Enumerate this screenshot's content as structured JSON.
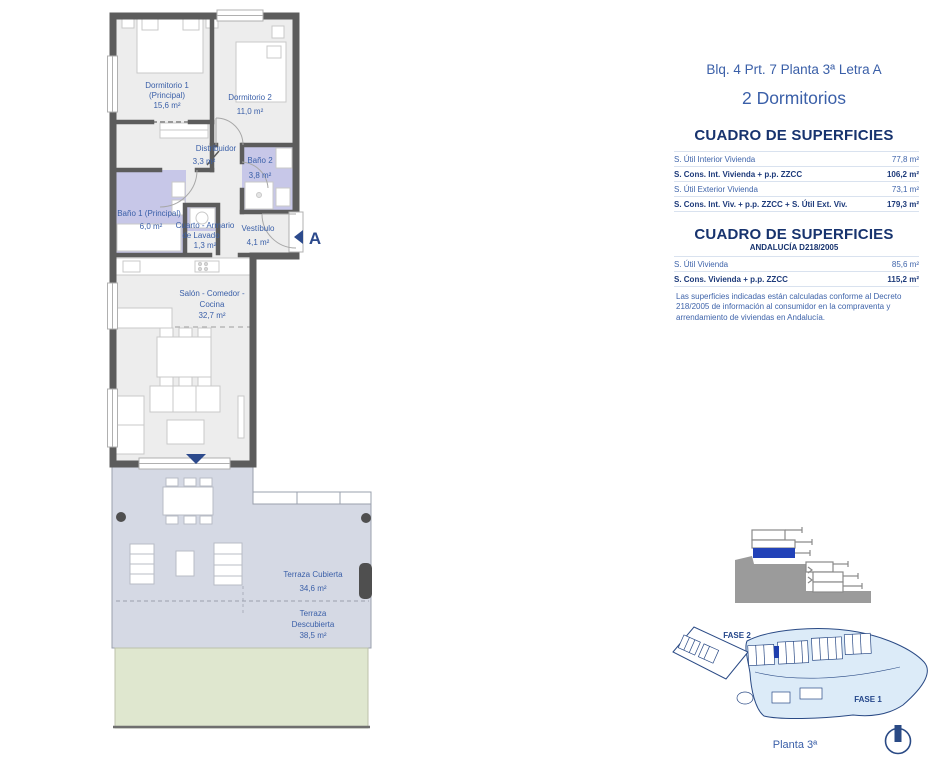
{
  "header": {
    "title": "Blq. 4 Prt. 7 Planta 3ª Letra A",
    "subtitle": "2 Dormitorios"
  },
  "surfaces": {
    "heading": "CUADRO DE SUPERFICIES",
    "rows": [
      {
        "label": "S. Útil Interior Vivienda",
        "value": "77,8 m²"
      },
      {
        "label": "S. Cons. Int. Vivienda + p.p. ZZCC",
        "value": "106,2 m²"
      },
      {
        "label": "S. Útil Exterior Vivienda",
        "value": "73,1 m²"
      },
      {
        "label": "S. Cons. Int. Viv. + p.p. ZZCC + S. Útil Ext. Viv.",
        "value": "179,3 m²"
      }
    ]
  },
  "surfaces_andalucia": {
    "heading": "CUADRO DE SUPERFICIES",
    "subheading": "ANDALUCÍA D218/2005",
    "rows": [
      {
        "label": "S. Útil Vivienda",
        "value": "85,6 m²"
      },
      {
        "label": "S. Cons. Vivienda + p.p. ZZCC",
        "value": "115,2 m²"
      }
    ],
    "note": "Las superficies indicadas están calculadas conforme al Decreto 218/2005 de información al consumidor en la compraventa y arrendamiento de viviendas en Andalucía."
  },
  "floorplan": {
    "rooms": {
      "dormitorio1": {
        "name": "Dormitorio 1",
        "sub": "(Principal)",
        "area": "15,6 m²"
      },
      "dormitorio2": {
        "name": "Dormitorio 2",
        "area": "11,0 m²"
      },
      "distribuidor": {
        "name": "Distribuidor",
        "area": "3,3 m²"
      },
      "bano2": {
        "name": "Baño 2",
        "area": "3,8 m²"
      },
      "bano1": {
        "name": "Baño 1 (Principal)",
        "area": "6,0 m²"
      },
      "lavado": {
        "name": "Cuarto - Armario",
        "name2": "de Lavado",
        "area": "1,3 m²"
      },
      "vestibulo": {
        "name": "Vestíbulo",
        "area": "4,1 m²"
      },
      "salon": {
        "name": "Salón - Comedor -",
        "name2": "Cocina",
        "area": "32,7 m²"
      },
      "terraza_cubierta": {
        "name": "Terraza Cubierta",
        "area": "34,6 m²"
      },
      "terraza_descubierta": {
        "name": "Terraza",
        "name2": "Descubierta",
        "area": "38,5 m²"
      }
    },
    "section_marker": "A"
  },
  "site": {
    "fase1": "FASE 1",
    "fase2": "FASE 2",
    "caption": "Planta 3ª"
  },
  "colors": {
    "accent_blue": "#3a5fa8",
    "navy": "#17336e",
    "wall_gray": "#5c5c5c",
    "bathroom_lavender": "#c7c7e8",
    "terrace_gray_blue": "#d5d9e4",
    "garden_green": "#dfe7cf",
    "marker_blue": "#2c4a8c",
    "section_blue": "#2242b8",
    "siteplan_fill": "#dcebf8"
  }
}
